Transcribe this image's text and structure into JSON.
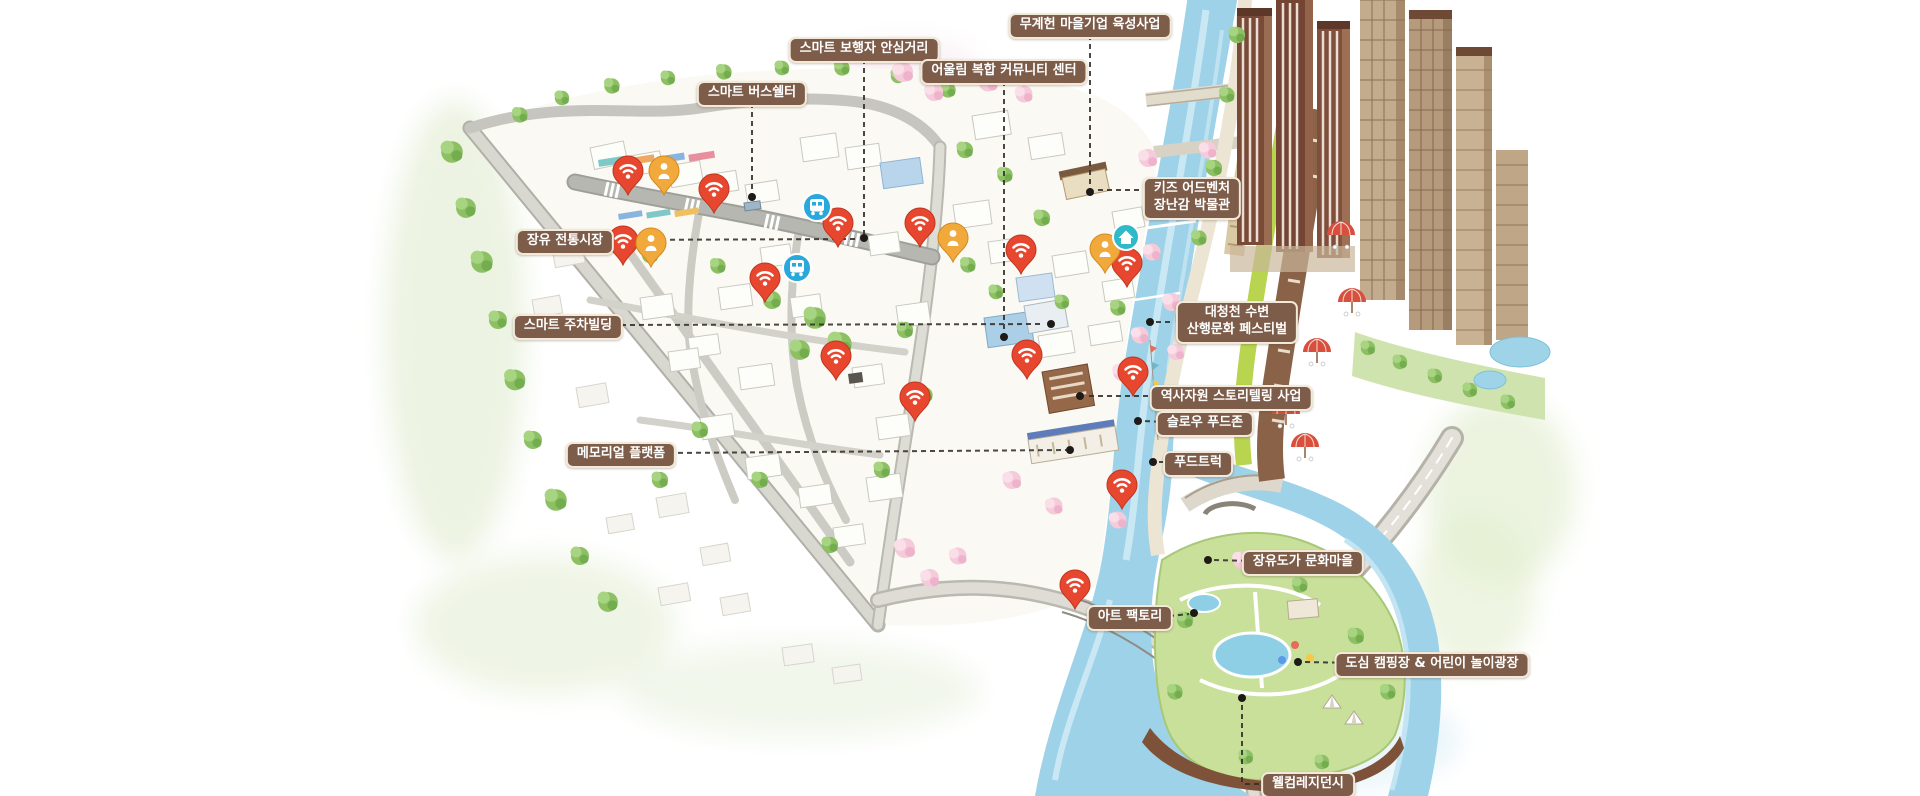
{
  "map": {
    "kind": "illustrated-birdseye-urban-regeneration-map",
    "language": "ko"
  },
  "labels": [
    {
      "id": "smart-pedestrian-street",
      "lines": [
        "스마트 보행자 안심거리"
      ]
    },
    {
      "id": "smart-bus-shelter",
      "lines": [
        "스마트 버스쉘터"
      ]
    },
    {
      "id": "mugyeheon-village-business",
      "lines": [
        "무계헌 마을기업 육성사업"
      ]
    },
    {
      "id": "eoullim-community-center",
      "lines": [
        "어울림 복합 커뮤니티 센터"
      ]
    },
    {
      "id": "kids-adventure-toy-museum",
      "lines": [
        "키즈 어드벤처",
        "장난감 박물관"
      ]
    },
    {
      "id": "jangyu-traditional-market",
      "lines": [
        "장유 전통시장"
      ]
    },
    {
      "id": "daecheongcheon-festival",
      "lines": [
        "대청천 수변",
        "산행문화 페스티벌"
      ]
    },
    {
      "id": "smart-parking-building",
      "lines": [
        "스마트 주차빌딩"
      ]
    },
    {
      "id": "history-storytelling",
      "lines": [
        "역사자원 스토리텔링 사업"
      ]
    },
    {
      "id": "slow-food-zone",
      "lines": [
        "슬로우 푸드존"
      ]
    },
    {
      "id": "memorial-platform",
      "lines": [
        "메모리얼 플랫폼"
      ]
    },
    {
      "id": "food-truck",
      "lines": [
        "푸드트럭"
      ]
    },
    {
      "id": "jangyudoga-culture-village",
      "lines": [
        "장유도가 문화마을"
      ]
    },
    {
      "id": "art-factory",
      "lines": [
        "아트 팩토리"
      ]
    },
    {
      "id": "city-camping-playground",
      "lines": [
        "도심 캠핑장 & 어린이 놀이광장"
      ]
    },
    {
      "id": "welcome-residency",
      "lines": [
        "웰컴레지던시"
      ]
    }
  ],
  "markers": {
    "wifi_pins": {
      "icon": "wifi-pin-icon",
      "color": "#e8472f",
      "count": 14,
      "positions": [
        [
          628,
          171
        ],
        [
          714,
          189
        ],
        [
          838,
          223
        ],
        [
          623,
          241
        ],
        [
          765,
          278
        ],
        [
          920,
          223
        ],
        [
          1021,
          250
        ],
        [
          1127,
          263
        ],
        [
          836,
          356
        ],
        [
          1027,
          355
        ],
        [
          1133,
          372
        ],
        [
          915,
          397
        ],
        [
          1122,
          485
        ],
        [
          1075,
          585
        ]
      ]
    },
    "person_pins": {
      "icon": "person-pin-icon",
      "color": "#f2a93b",
      "count": 4,
      "positions": [
        [
          664,
          171
        ],
        [
          651,
          243
        ],
        [
          953,
          238
        ],
        [
          1105,
          249
        ]
      ]
    },
    "bus_badges": {
      "icon": "bus-circle-icon",
      "color": "#29a8dc",
      "count": 2,
      "positions": [
        [
          817,
          207
        ],
        [
          797,
          268
        ]
      ]
    },
    "house_badges": {
      "icon": "house-circle-icon",
      "color": "#2fb9c9",
      "count": 1,
      "positions": [
        [
          1126,
          237
        ]
      ]
    }
  },
  "colors": {
    "label_background": "#7d5c49",
    "label_border": "#f2e9d8",
    "label_text": "#ffffff",
    "leader_line": "#332d28",
    "river": "#9ed2e8",
    "park_green": "#c8e09a",
    "road": "#c6c5bf",
    "apartment_brown": "#7a4a38",
    "apartment_beige": "#bfa183",
    "umbrella_red": "#d94f3d"
  }
}
